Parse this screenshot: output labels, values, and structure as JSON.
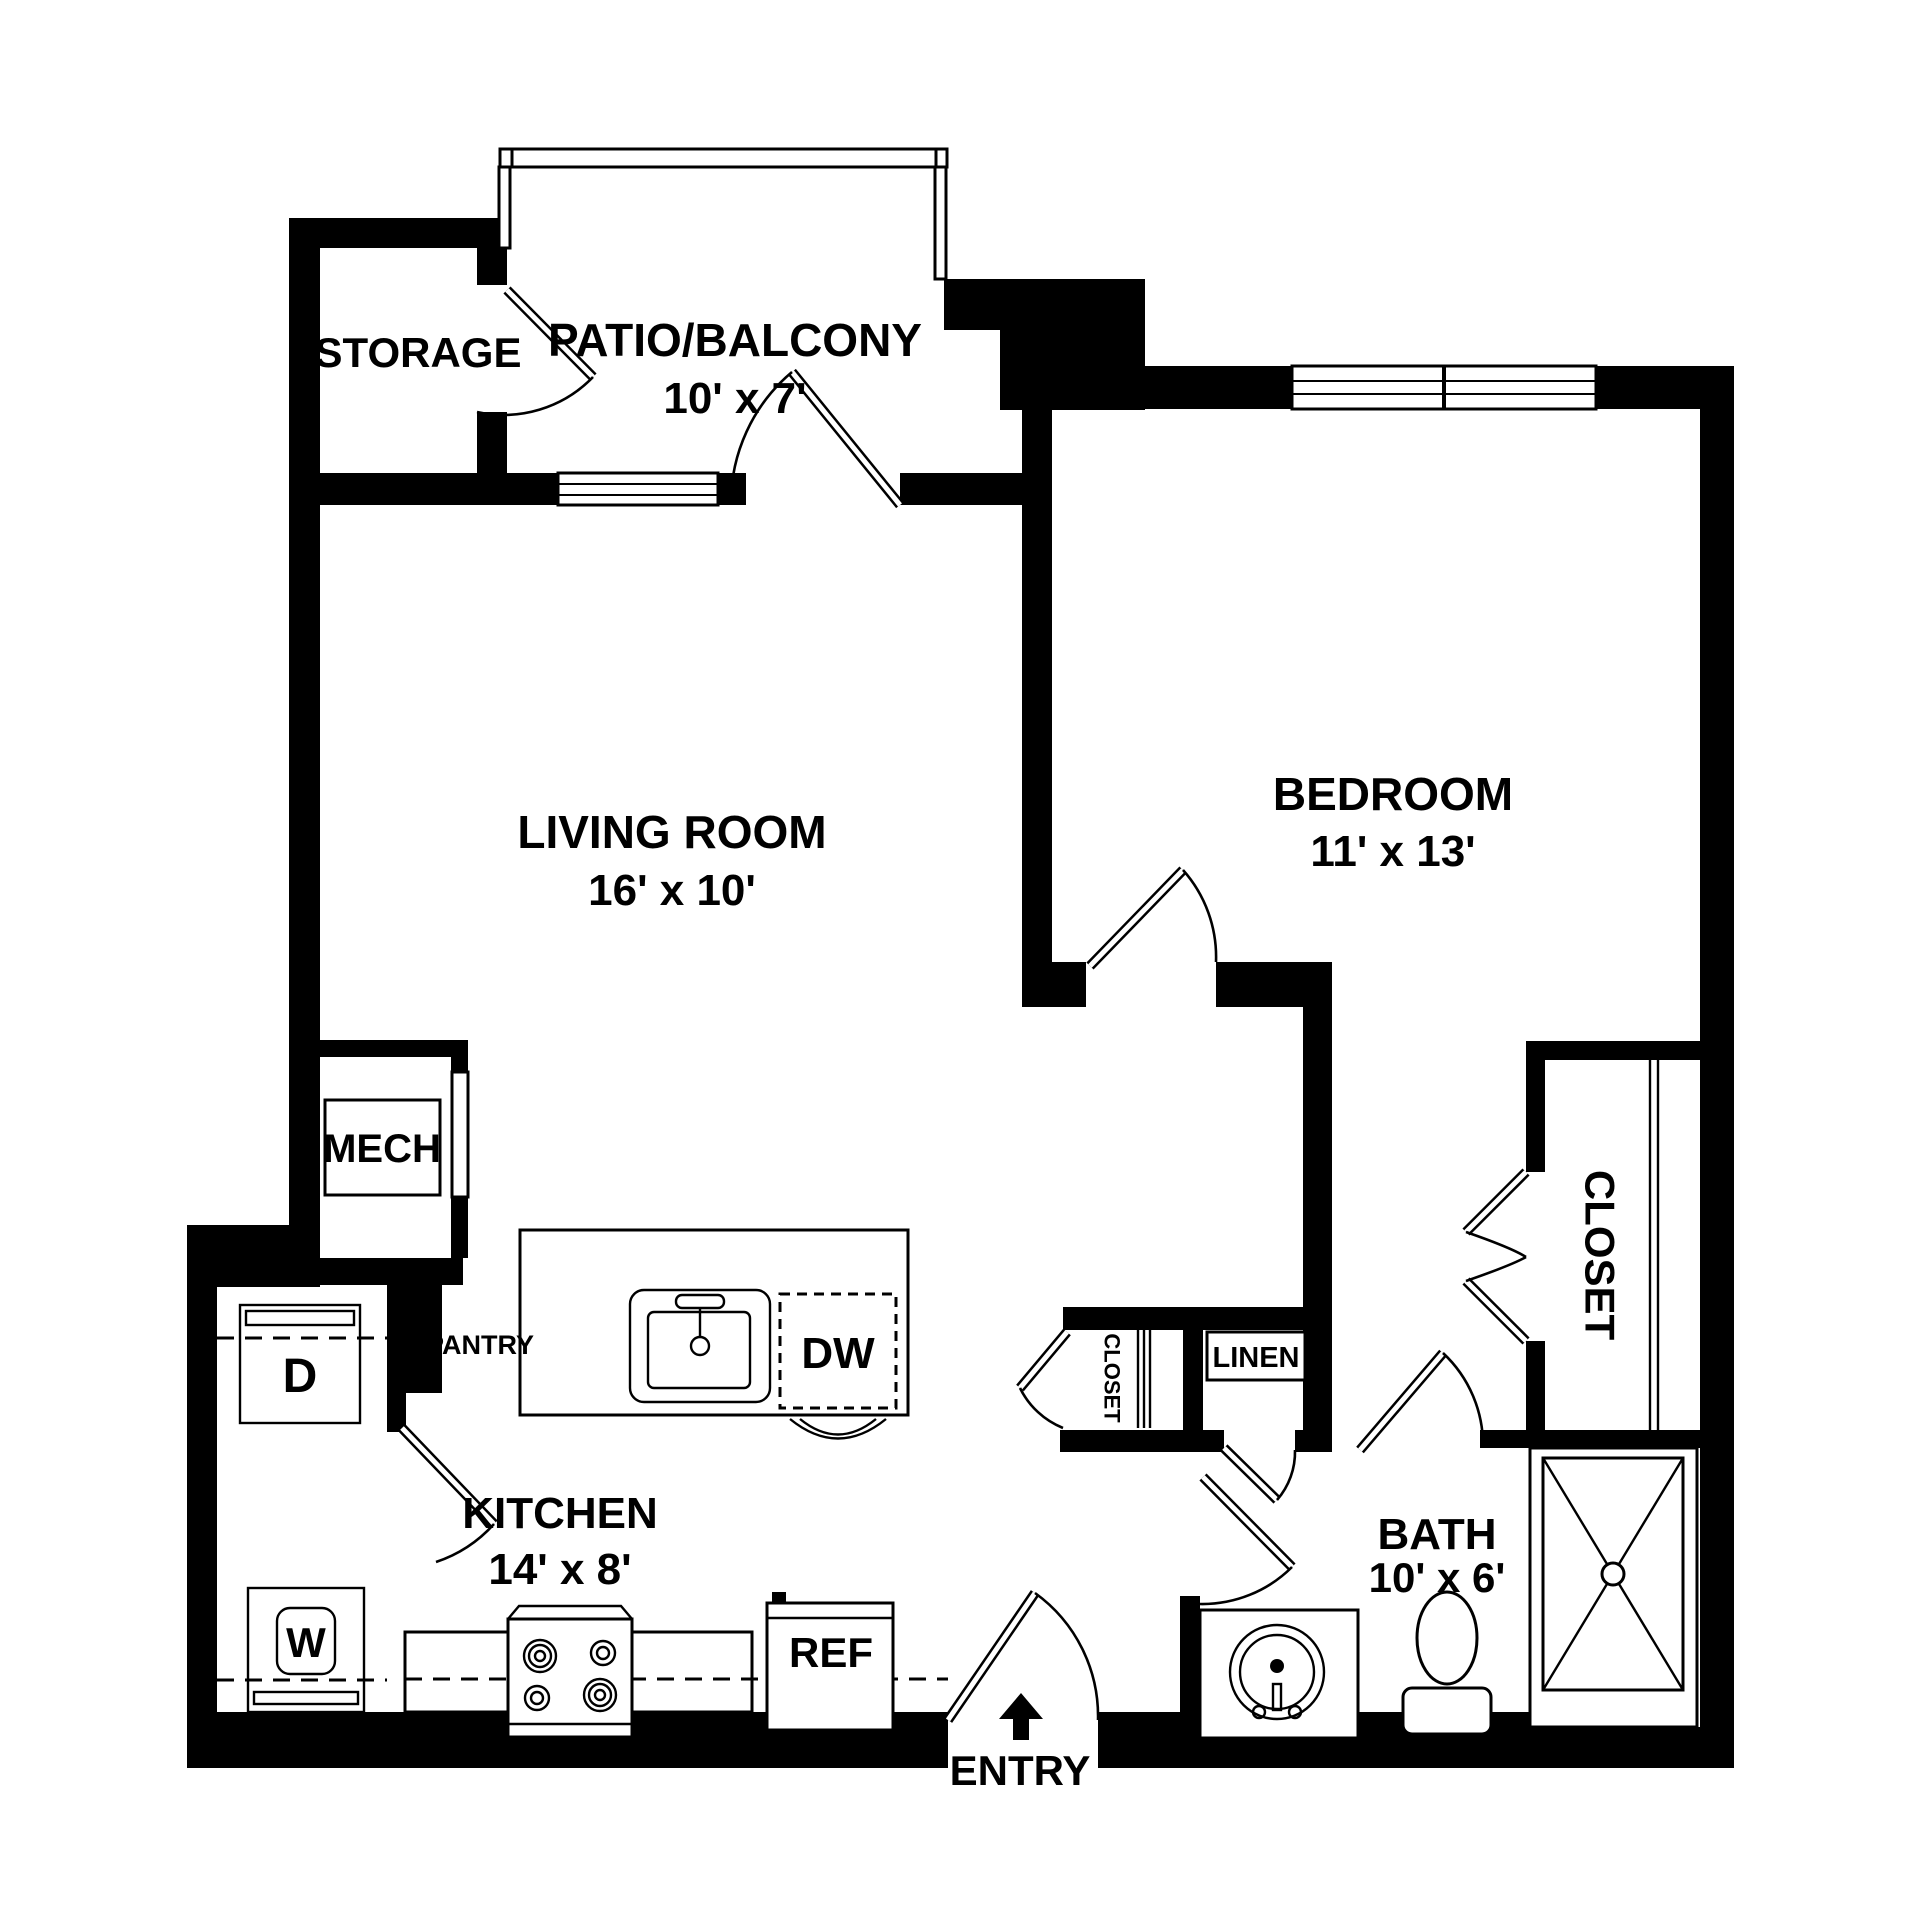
{
  "plan": {
    "rooms": {
      "patio": {
        "name": "PATIO/BALCONY",
        "dims": "10' x 7'"
      },
      "storage": {
        "name": "STORAGE"
      },
      "living": {
        "name": "LIVING ROOM",
        "dims": "16' x 10'"
      },
      "bedroom": {
        "name": "BEDROOM",
        "dims": "11' x 13'"
      },
      "kitchen": {
        "name": "KITCHEN",
        "dims": "14' x 8'"
      },
      "bath": {
        "name": "BATH",
        "dims": "10' x 6'"
      },
      "mech": {
        "name": "MECH"
      },
      "pantry": {
        "name": "PANTRY"
      },
      "linen": {
        "name": "LINEN"
      },
      "hall_closet": {
        "name": "CLOSET"
      },
      "bedroom_closet": {
        "name": "CLOSET"
      }
    },
    "entry": {
      "label": "ENTRY"
    },
    "appliances": {
      "dishwasher": "DW",
      "dryer": "D",
      "washer": "W",
      "refrigerator": "REF"
    },
    "colors": {
      "wall": "#000000",
      "background": "#ffffff",
      "line": "#000000"
    }
  }
}
